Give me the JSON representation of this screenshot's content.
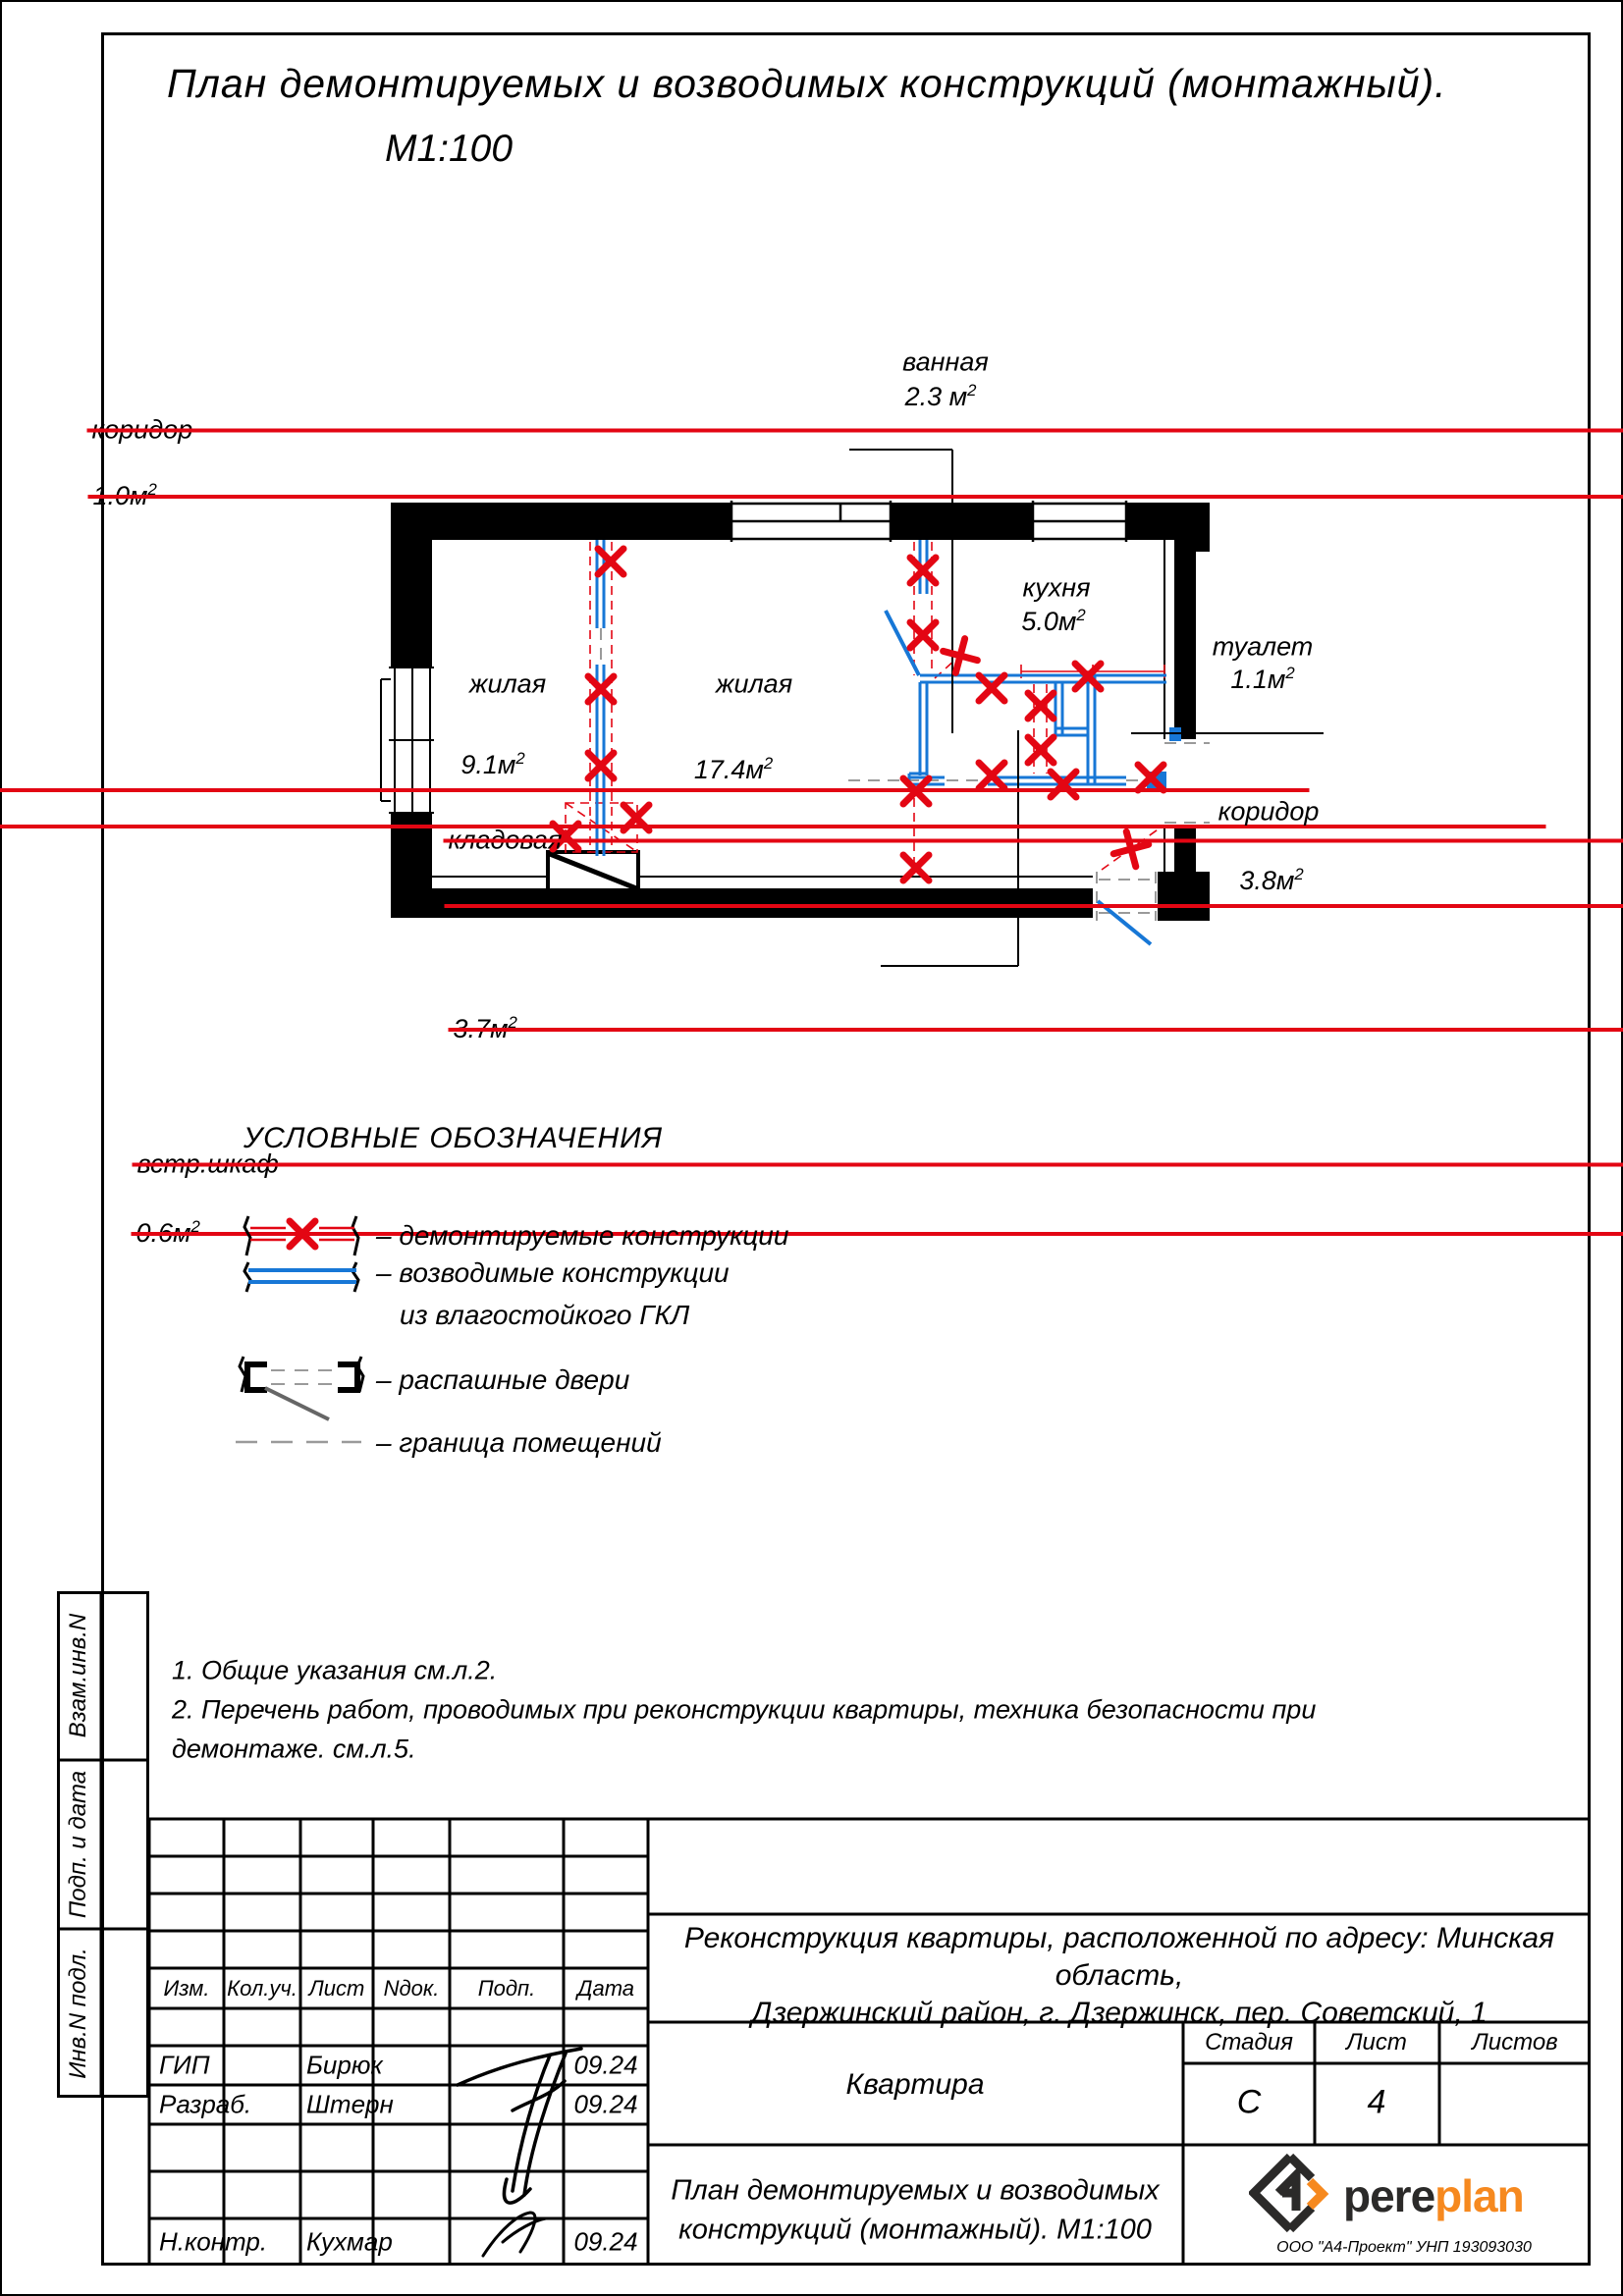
{
  "drawing": {
    "title": "План демонтируемых и возводимых конструкций (монтажный).",
    "scale": "М1:100"
  },
  "plan": {
    "labels": {
      "vannaya": {
        "name": "ванная",
        "area": "2.3 м",
        "sup": "2"
      },
      "koridor_top": {
        "name": "коридор",
        "area": "1.0м",
        "sup": "2"
      },
      "kuhnya": {
        "name": "кухня",
        "area": "5.0м",
        "sup": "2"
      },
      "zhilaya1": {
        "name": "жилая",
        "area_old": "9.2м",
        "area_new": "9.1м",
        "sup": "2"
      },
      "zhilaya2": {
        "name": "жилая",
        "area_old": "17.1м",
        "area_new": "17.4м",
        "sup": "2"
      },
      "tualet": {
        "name": "туалет",
        "area": "1.1м",
        "sup": "2"
      },
      "kladovaya": {
        "name": "кладовая",
        "area": "1.9м",
        "sup": "2"
      },
      "koridor_right": {
        "name": "коридор",
        "area_old": "3.7м",
        "area_new": "3.8м",
        "sup": "2"
      },
      "vstr_shkaf": {
        "name": "встр.шкаф",
        "area": "0.6м",
        "sup": "2"
      }
    }
  },
  "legend": {
    "heading": "УСЛОВНЫЕ ОБОЗНАЧЕНИЯ",
    "item1": "–  демонтируемые конструкции",
    "item2_line1": "–  возводимые конструкции",
    "item2_line2": "из влагостойкого ГКЛ",
    "item3": "–  распашные двери",
    "item4": "–  граница помещений"
  },
  "notes": {
    "line1": "1.  Общие указания см.л.2.",
    "line2": "2.  Перечень работ, проводимых при реконструкции квартиры, техника безопасности при",
    "line3": "демонтаже. см.л.5."
  },
  "sidebar": {
    "labels": [
      "Взам.инв.N",
      "Подп. и дата",
      "Инв.N подл."
    ]
  },
  "titleblock": {
    "header_cols": [
      "Изм.",
      "Кол.уч.",
      "Лист",
      "Nдок.",
      "Подп.",
      "Дата"
    ],
    "rows": [
      {
        "role": "ГИП",
        "name": "Бирюк",
        "date": "09.24"
      },
      {
        "role": "Разраб.",
        "name": "Штерн",
        "date": "09.24"
      },
      {
        "role": "Н.контр.",
        "name": "Кухмар",
        "date": "09.24"
      }
    ],
    "project_line1": "Реконструкция квартиры, расположенной по адресу: Минская область,",
    "project_line2": "Дзержинский район, г. Дзержинск, пер. Советский, 1",
    "object": "Квартира",
    "stage_label": "Стадия",
    "sheet_label": "Лист",
    "sheets_label": "Листов",
    "stage": "С",
    "sheet": "4",
    "doc_title_line1": "План демонтируемых и возводимых",
    "doc_title_line2": "конструкций (монтажный). М1:100",
    "brand_word_dark": "pere",
    "brand_word_accent": "plan",
    "company": "ООО \"А4-Проект\" УНП 193093030"
  },
  "colors": {
    "red": "#e30613",
    "blue": "#1777d6",
    "gray": "#9a9a9a",
    "orange": "#f6891f",
    "dark": "#2b2a29"
  }
}
